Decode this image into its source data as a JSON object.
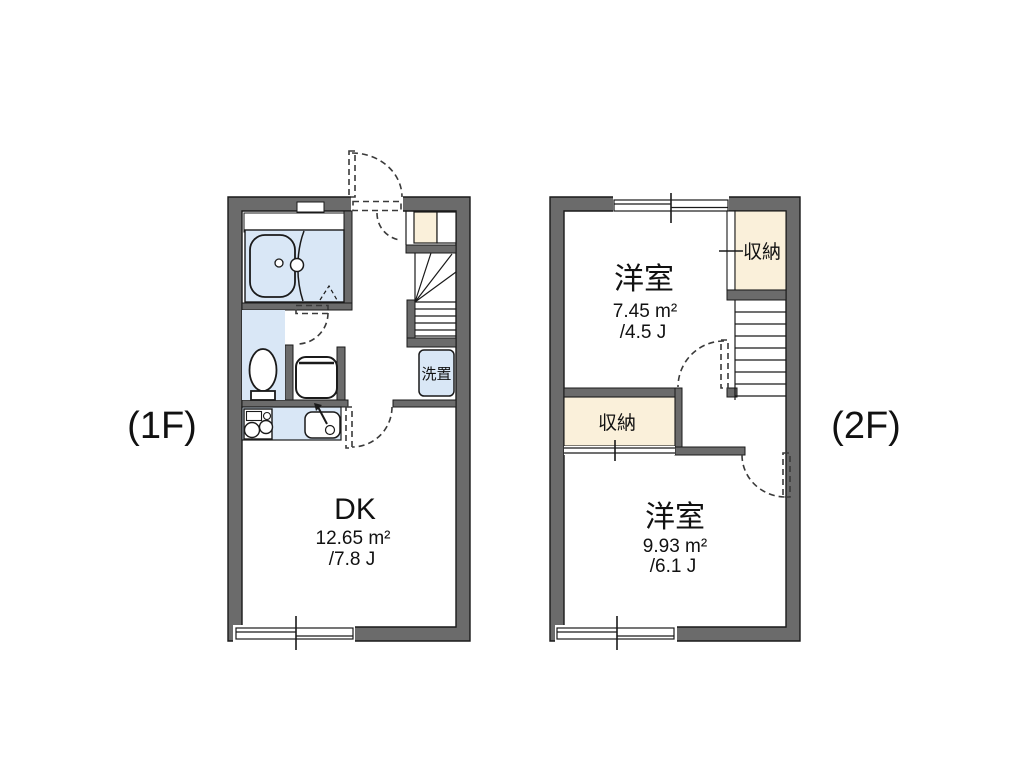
{
  "colors": {
    "wall": "#6b6b6b",
    "fixture_blue": "#d9e7f6",
    "closet_beige": "#faf0da",
    "line": "#1a1a1a",
    "background": "#ffffff"
  },
  "floor1": {
    "label": "(1F)",
    "dk": {
      "name": "DK",
      "area": "12.65 m²",
      "size_jo": "/7.8 J"
    },
    "laundry_label": "洗置"
  },
  "floor2": {
    "label": "(2F)",
    "room_top": {
      "name": "洋室",
      "area": "7.45 m²",
      "size_jo": "/4.5 J"
    },
    "room_bottom": {
      "name": "洋室",
      "area": "9.93 m²",
      "size_jo": "/6.1 J"
    },
    "closet_top_label": "収納",
    "closet_bottom_label": "収納"
  }
}
